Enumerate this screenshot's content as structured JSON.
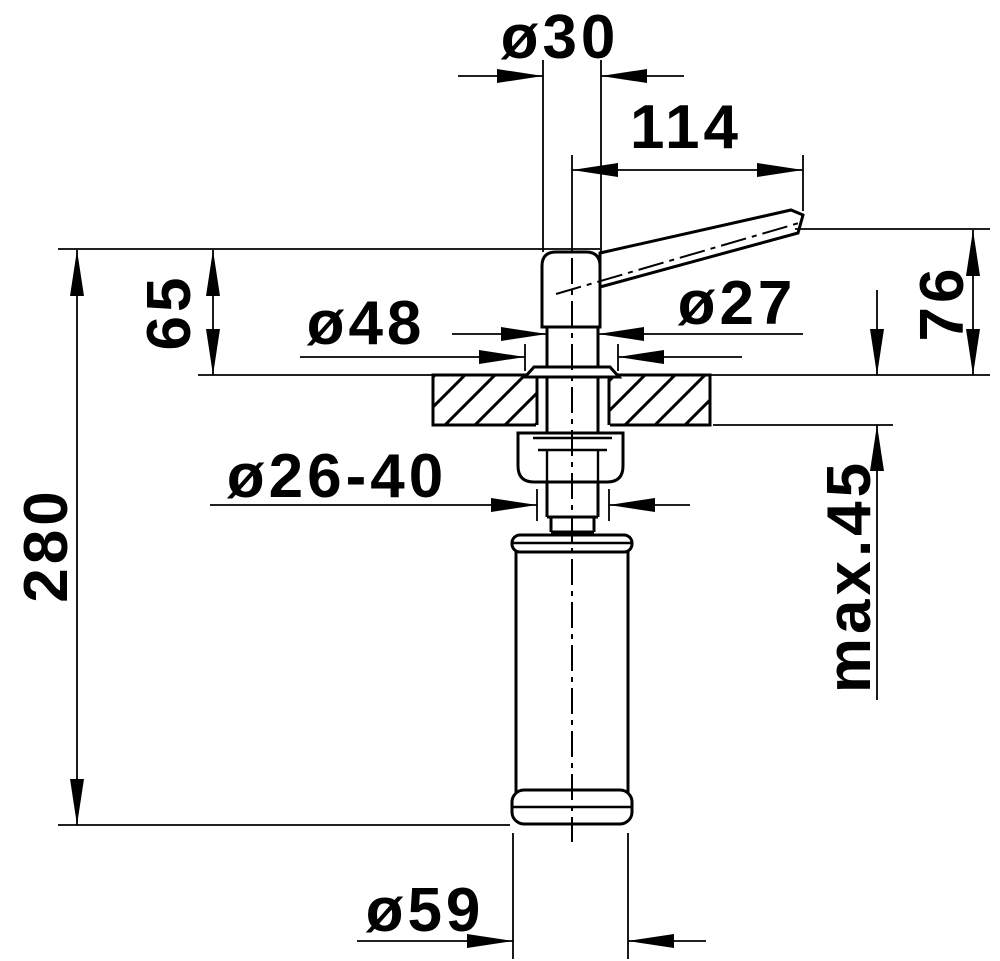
{
  "drawing": {
    "kind": "technical installation drawing",
    "subject": "soap dispenser side elevation with mounting through countertop"
  },
  "colors": {
    "ink": "#000000",
    "paper": "#ffffff"
  },
  "labels": {
    "head_diameter": "ø30",
    "spout_reach": "114",
    "height_head_above_counter": "65",
    "flange_diameter": "ø48",
    "shaft_diameter": "ø27",
    "spout_height_above_counter": "76",
    "total_height": "280",
    "mounting_hole_diameter": "ø26-40",
    "max_counter_thickness": "max.45",
    "bottle_diameter": "ø59"
  }
}
